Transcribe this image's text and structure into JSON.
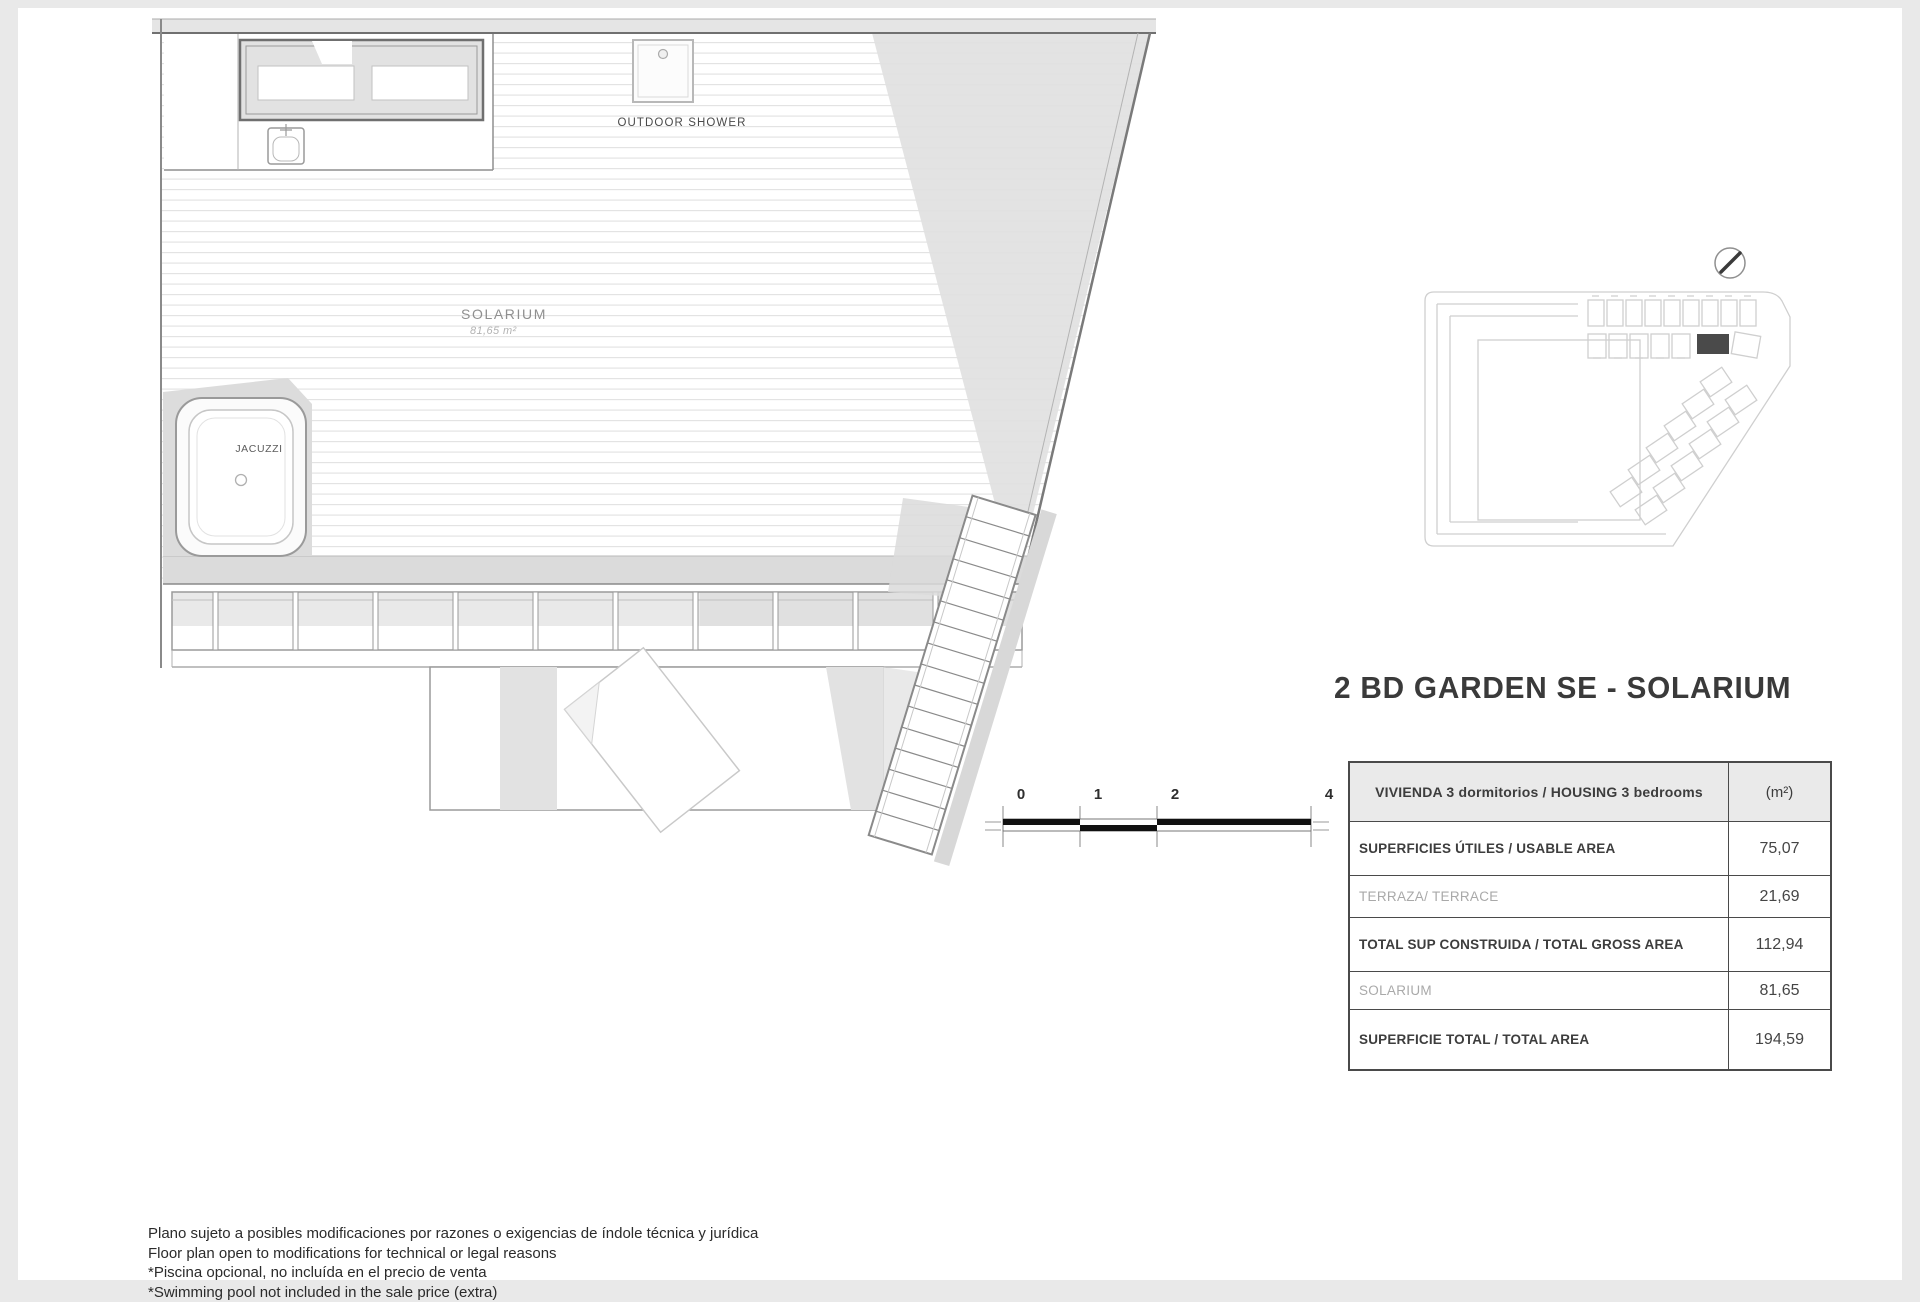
{
  "page": {
    "title": "2 BD GARDEN SE - SOLARIUM"
  },
  "plan": {
    "labels": {
      "solarium": "SOLARIUM",
      "solarium_area": "81,65 m²",
      "jacuzzi": "JACUZZI",
      "outdoor_shower": "OUTDOOR SHOWER"
    },
    "scale_bar": {
      "ticks": [
        "0",
        "1",
        "2",
        "4"
      ]
    }
  },
  "area_table": {
    "header": {
      "label": "VIVIENDA 3 dormitorios / HOUSING 3 bedrooms",
      "unit": "(m²)"
    },
    "rows": [
      {
        "label": "SUPERFICIES ÚTILES / USABLE AREA",
        "value": "75,07",
        "emphasis": "bold"
      },
      {
        "label": "TERRAZA/ TERRACE",
        "value": "21,69",
        "emphasis": "light"
      },
      {
        "label": "TOTAL SUP CONSTRUIDA / TOTAL GROSS AREA",
        "value": "112,94",
        "emphasis": "bold"
      },
      {
        "label": "SOLARIUM",
        "value": "81,65",
        "emphasis": "light"
      },
      {
        "label": "SUPERFICIE TOTAL / TOTAL AREA",
        "value": "194,59",
        "emphasis": "bold"
      }
    ]
  },
  "footer": {
    "lines": [
      "Plano sujeto a posibles modificaciones por razones o exigencias de índole técnica y jurídica",
      "Floor plan open to modifications for technical or legal reasons",
      "*Piscina opcional, no incluída en el precio de venta",
      "*Swimming pool not included in the sale price (extra)"
    ]
  },
  "colors": {
    "highlighted_unit": "#4a4a4a",
    "table_border": "#4a4a4a",
    "deck_shadow": "#dcdcdc"
  }
}
